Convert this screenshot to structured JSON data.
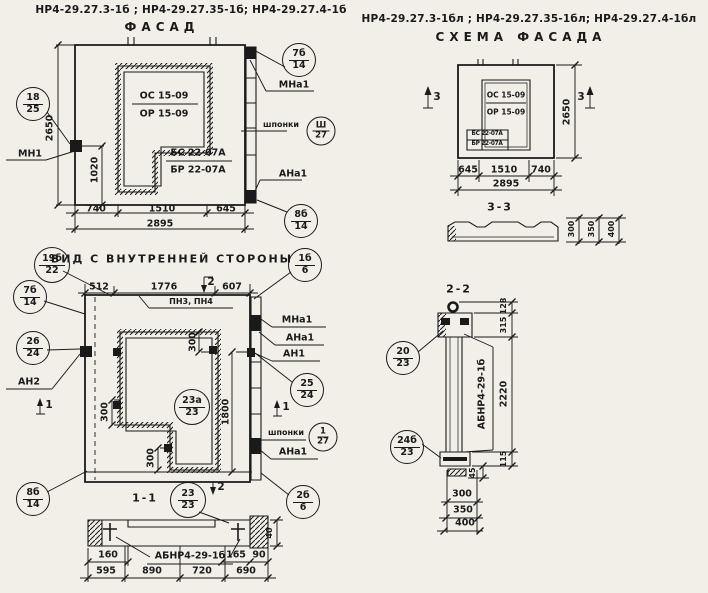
{
  "header": {
    "left_codes": "НР4-29.27.3-1б ; НР4-29.27.35-1б; НР4-29.27.4-1б",
    "facade_title": "ФАСАД",
    "right_codes": "НР4-29.27.3-1бл ; НР4-29.27.35-1бл; НР4-29.27.4-1бл",
    "schema_title": "СХЕМА ФАСАДА"
  },
  "facade": {
    "window_mark_top": "ОС 15-09",
    "window_mark_bottom": "ОР 15-09",
    "beam_mark_top": "БС 22-07А",
    "beam_mark_bottom": "БР 22-07А",
    "label_mn1": "МН1",
    "label_mna1": "МНа1",
    "label_shponki": "шпонки",
    "label_ana1": "АНа1",
    "dim_height": "2650",
    "dim_anchor": "1020",
    "dim_w1": "740",
    "dim_w2": "1510",
    "dim_w3": "645",
    "dim_total": "2895",
    "callout_left": {
      "top": "18",
      "bottom": "25"
    },
    "callout_top_right": {
      "top": "7б",
      "bottom": "14"
    },
    "callout_shponki": {
      "top": "Ш",
      "bottom": "27"
    },
    "callout_bottom_right": {
      "top": "8б",
      "bottom": "14"
    }
  },
  "inner": {
    "title": "ВИД С ВНУТРЕННЕЙ СТОРОНЫ",
    "dim_t1": "512",
    "dim_t2": "1776",
    "dim_t3": "607",
    "label_pn": "ПН3, ПН4",
    "marker_1": "1",
    "marker_2": "2",
    "label_mna1": "МНа1",
    "label_ana1_top": "АНа1",
    "label_an1": "АН1",
    "label_shponki": "шпонки",
    "label_ana1_bottom": "АНа1",
    "label_an2": "АН2",
    "dim_300_top": "300",
    "dim_300_left": "300",
    "dim_300_bottom": "300",
    "dim_1800": "1800",
    "callouts": {
      "c19b": {
        "top": "19б",
        "bottom": "22"
      },
      "c7b": {
        "top": "7б",
        "bottom": "14"
      },
      "c26": {
        "top": "26",
        "bottom": "24"
      },
      "c1b": {
        "top": "1б",
        "bottom": "6"
      },
      "c25": {
        "top": "25",
        "bottom": "24"
      },
      "c1_27": {
        "top": "1",
        "bottom": "27"
      },
      "c23a": {
        "top": "23а",
        "bottom": "23"
      },
      "c8b": {
        "top": "8б",
        "bottom": "14"
      },
      "c2b": {
        "top": "2б",
        "bottom": "6"
      }
    }
  },
  "s11": {
    "title": "1-1",
    "callout": {
      "top": "23",
      "bottom": "23"
    },
    "label_abnr": "АБНР4-29-1б",
    "dim_160": "160",
    "dim_165": "165",
    "dim_90": "90",
    "dim_40": "40",
    "dim_b1": "595",
    "dim_b2": "890",
    "dim_b3": "720",
    "dim_b4": "690"
  },
  "schema": {
    "window_mark_top": "ОС 15-09",
    "window_mark_bottom": "ОР 15-09",
    "beam_mark_top": "БС 22-07А",
    "beam_mark_bottom": "БР 22-07А",
    "marker_3": "3",
    "dim_height": "2650",
    "dim_w1": "645",
    "dim_w2": "1510",
    "dim_w3": "740",
    "dim_total": "2895",
    "s33_title": "3-3",
    "dim_s1": "300",
    "dim_s2": "350",
    "dim_s3": "400"
  },
  "s22": {
    "title": "2-2",
    "callout_top": {
      "top": "20",
      "bottom": "23"
    },
    "callout_bottom": {
      "top": "24б",
      "bottom": "23"
    },
    "label_abnr": "АБНР4-29-1б",
    "dim_128": "128",
    "dim_315": "315",
    "dim_2220": "2220",
    "dim_115": "115",
    "dim_45": "45",
    "dim_b1": "300",
    "dim_b2": "350",
    "dim_b3": "400"
  }
}
